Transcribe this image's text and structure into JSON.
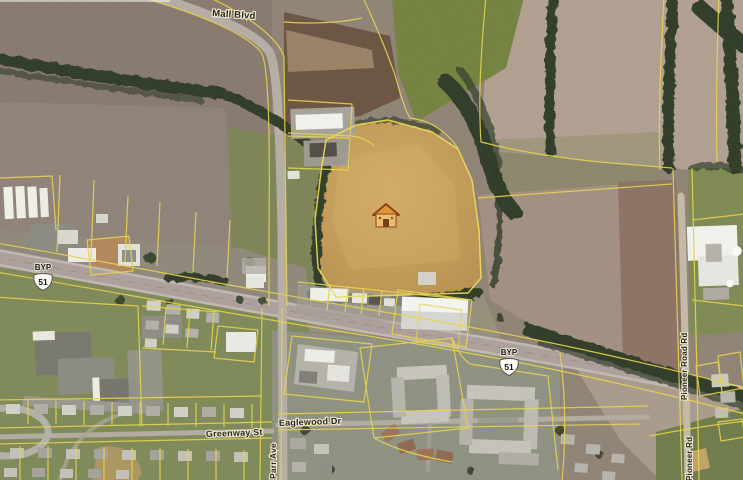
{
  "map": {
    "kind": "aerial-parcel-map",
    "roads": {
      "mall_blvd": "Mall Blvd",
      "greenway_st": "Greenway St",
      "eaglewood_dr": "Eaglewood Dr",
      "parr_ave": "Parr Ave",
      "pioneer_road_rd": "Pioneer Road Rd",
      "pioneer_rd": "Pioneer Rd"
    },
    "shields": {
      "bypass_label": "BYP",
      "route_number": "51"
    },
    "colors": {
      "parcel_line": "#e8d44b",
      "highlight_parcel": "#c49d58",
      "house_icon_roof": "#8d3f1f",
      "tree": "#2f3a27"
    }
  }
}
